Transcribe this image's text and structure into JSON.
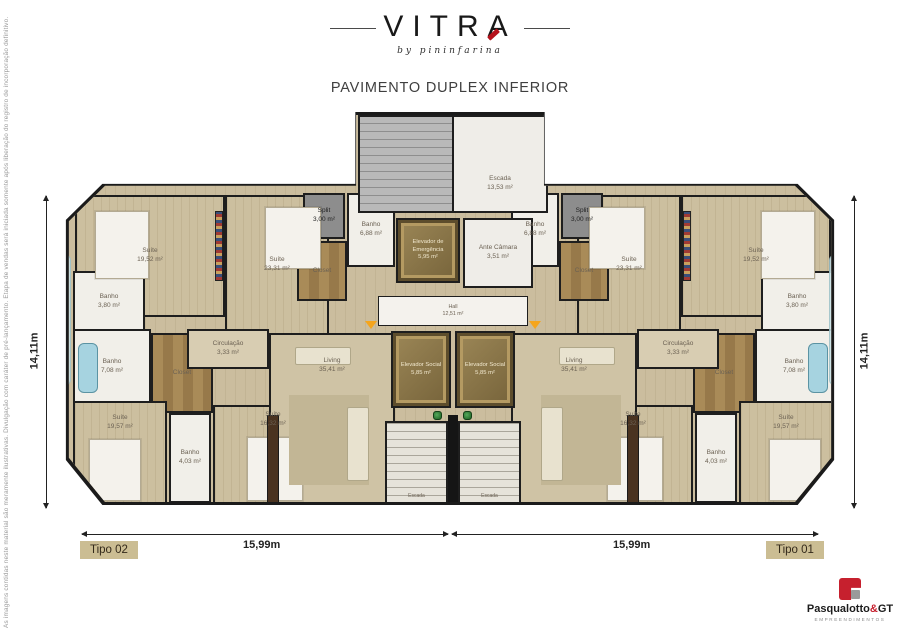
{
  "page": {
    "brand": "VITRA",
    "brand_sub": "by pininfarina",
    "title": "PAVIMENTO DUPLEX INFERIOR",
    "disclaimer": "As imagens contidas neste material são meramente ilustrativas. Divulgação com caráter de pré-lançamento. Etapa de vendas será iniciada somente após liberação do registro de incorporação definitivo."
  },
  "dimensions": {
    "height_left": "14,11m",
    "height_right": "14,11m",
    "width_left": "15,99m",
    "width_right": "15,99m"
  },
  "unit_labels": {
    "left": "Tipo 02",
    "right": "Tipo 01"
  },
  "rooms": {
    "suite_19_52": {
      "name": "Suíte",
      "area": "19,52 m²"
    },
    "suite_23_31": {
      "name": "Suíte",
      "area": "23,31 m²"
    },
    "suite_19_57": {
      "name": "Suíte",
      "area": "19,57 m²"
    },
    "suite_16_32": {
      "name": "Suíte",
      "area": "16,32 m²"
    },
    "banho_3_80": {
      "name": "Banho",
      "area": "3,80 m²"
    },
    "banho_6_88": {
      "name": "Banho",
      "area": "6,88 m²"
    },
    "banho_7_08": {
      "name": "Banho",
      "area": "7,08 m²"
    },
    "banho_4_03": {
      "name": "Banho",
      "area": "4,03 m²"
    },
    "split": {
      "name": "Split",
      "area": "3,00 m²"
    },
    "closet": {
      "name": "Closet",
      "area": ""
    },
    "circulacao": {
      "name": "Circulação",
      "area": "3,33 m²"
    },
    "living": {
      "name": "Living",
      "area": "35,41 m²"
    },
    "escada_unit": {
      "name": "Escada",
      "area": ""
    }
  },
  "core": {
    "escada": {
      "name": "Escada",
      "area": "13,53 m²"
    },
    "elevador_emergencia": {
      "name": "Elevador de Emergência",
      "area": "5,95 m²"
    },
    "ante_camara": {
      "name": "Ante Câmara",
      "area": "3,51 m²"
    },
    "hall": {
      "name": "Hall",
      "area": "12,51 m²"
    },
    "elevador_social_1": {
      "name": "Elevador Social",
      "area": "5,85 m²"
    },
    "elevador_social_2": {
      "name": "Elevador Social",
      "area": "5,85 m²"
    }
  },
  "footer": {
    "brand_main": "Pasqualotto",
    "brand_amp": "&",
    "brand_gt": "GT",
    "brand_sub": "EMPREENDIMENTOS"
  },
  "colors": {
    "accent_red": "#b5121b",
    "floor_beige": "#cbbd9e",
    "wall": "#1b1b1b",
    "gold": "#8a764a",
    "tipo_bg": "#cbbd93"
  }
}
